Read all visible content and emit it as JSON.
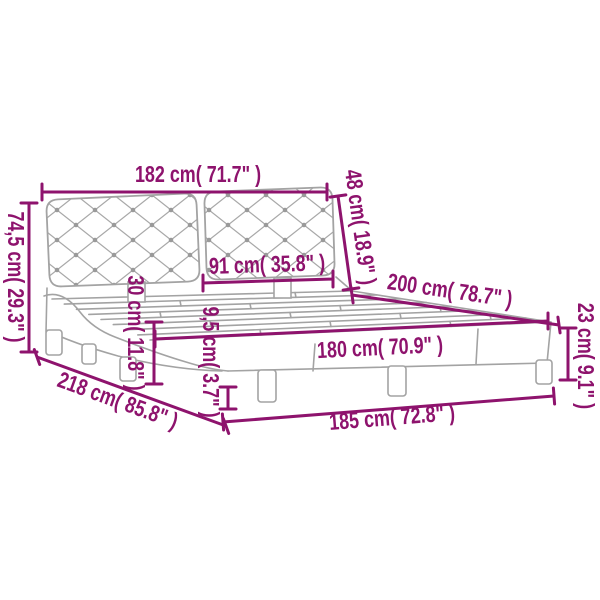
{
  "diagram": {
    "subject": "bed-frame-with-tufted-headboard-dimension-diagram",
    "background_color": "#ffffff",
    "dimension_color": "#8e136d",
    "artwork_color": "#a3a3a3",
    "dimensions": [
      {
        "id": "headboard-width",
        "label": "182 cm( 71.7\" )"
      },
      {
        "id": "headboard-total-height",
        "label": "74,5 cm( 29.3\" )"
      },
      {
        "id": "headboard-panel-height",
        "label": "48 cm( 18.9\" )"
      },
      {
        "id": "headboard-panel-width",
        "label": "91 cm( 35.8\" )"
      },
      {
        "id": "bed-length",
        "label": "200 cm( 78.7\" )"
      },
      {
        "id": "frame-side-height",
        "label": "30 cm( 11.8\" )"
      },
      {
        "id": "frame-base-height",
        "label": "9,5 cm( 3.7\" )"
      },
      {
        "id": "mattress-width",
        "label": "180 cm( 70.9\" )"
      },
      {
        "id": "leg-height",
        "label": "23 cm( 9.1\" )"
      },
      {
        "id": "total-length",
        "label": "218 cm( 85.8\" )"
      },
      {
        "id": "total-width",
        "label": "185 cm( 72.8\" )"
      }
    ]
  }
}
